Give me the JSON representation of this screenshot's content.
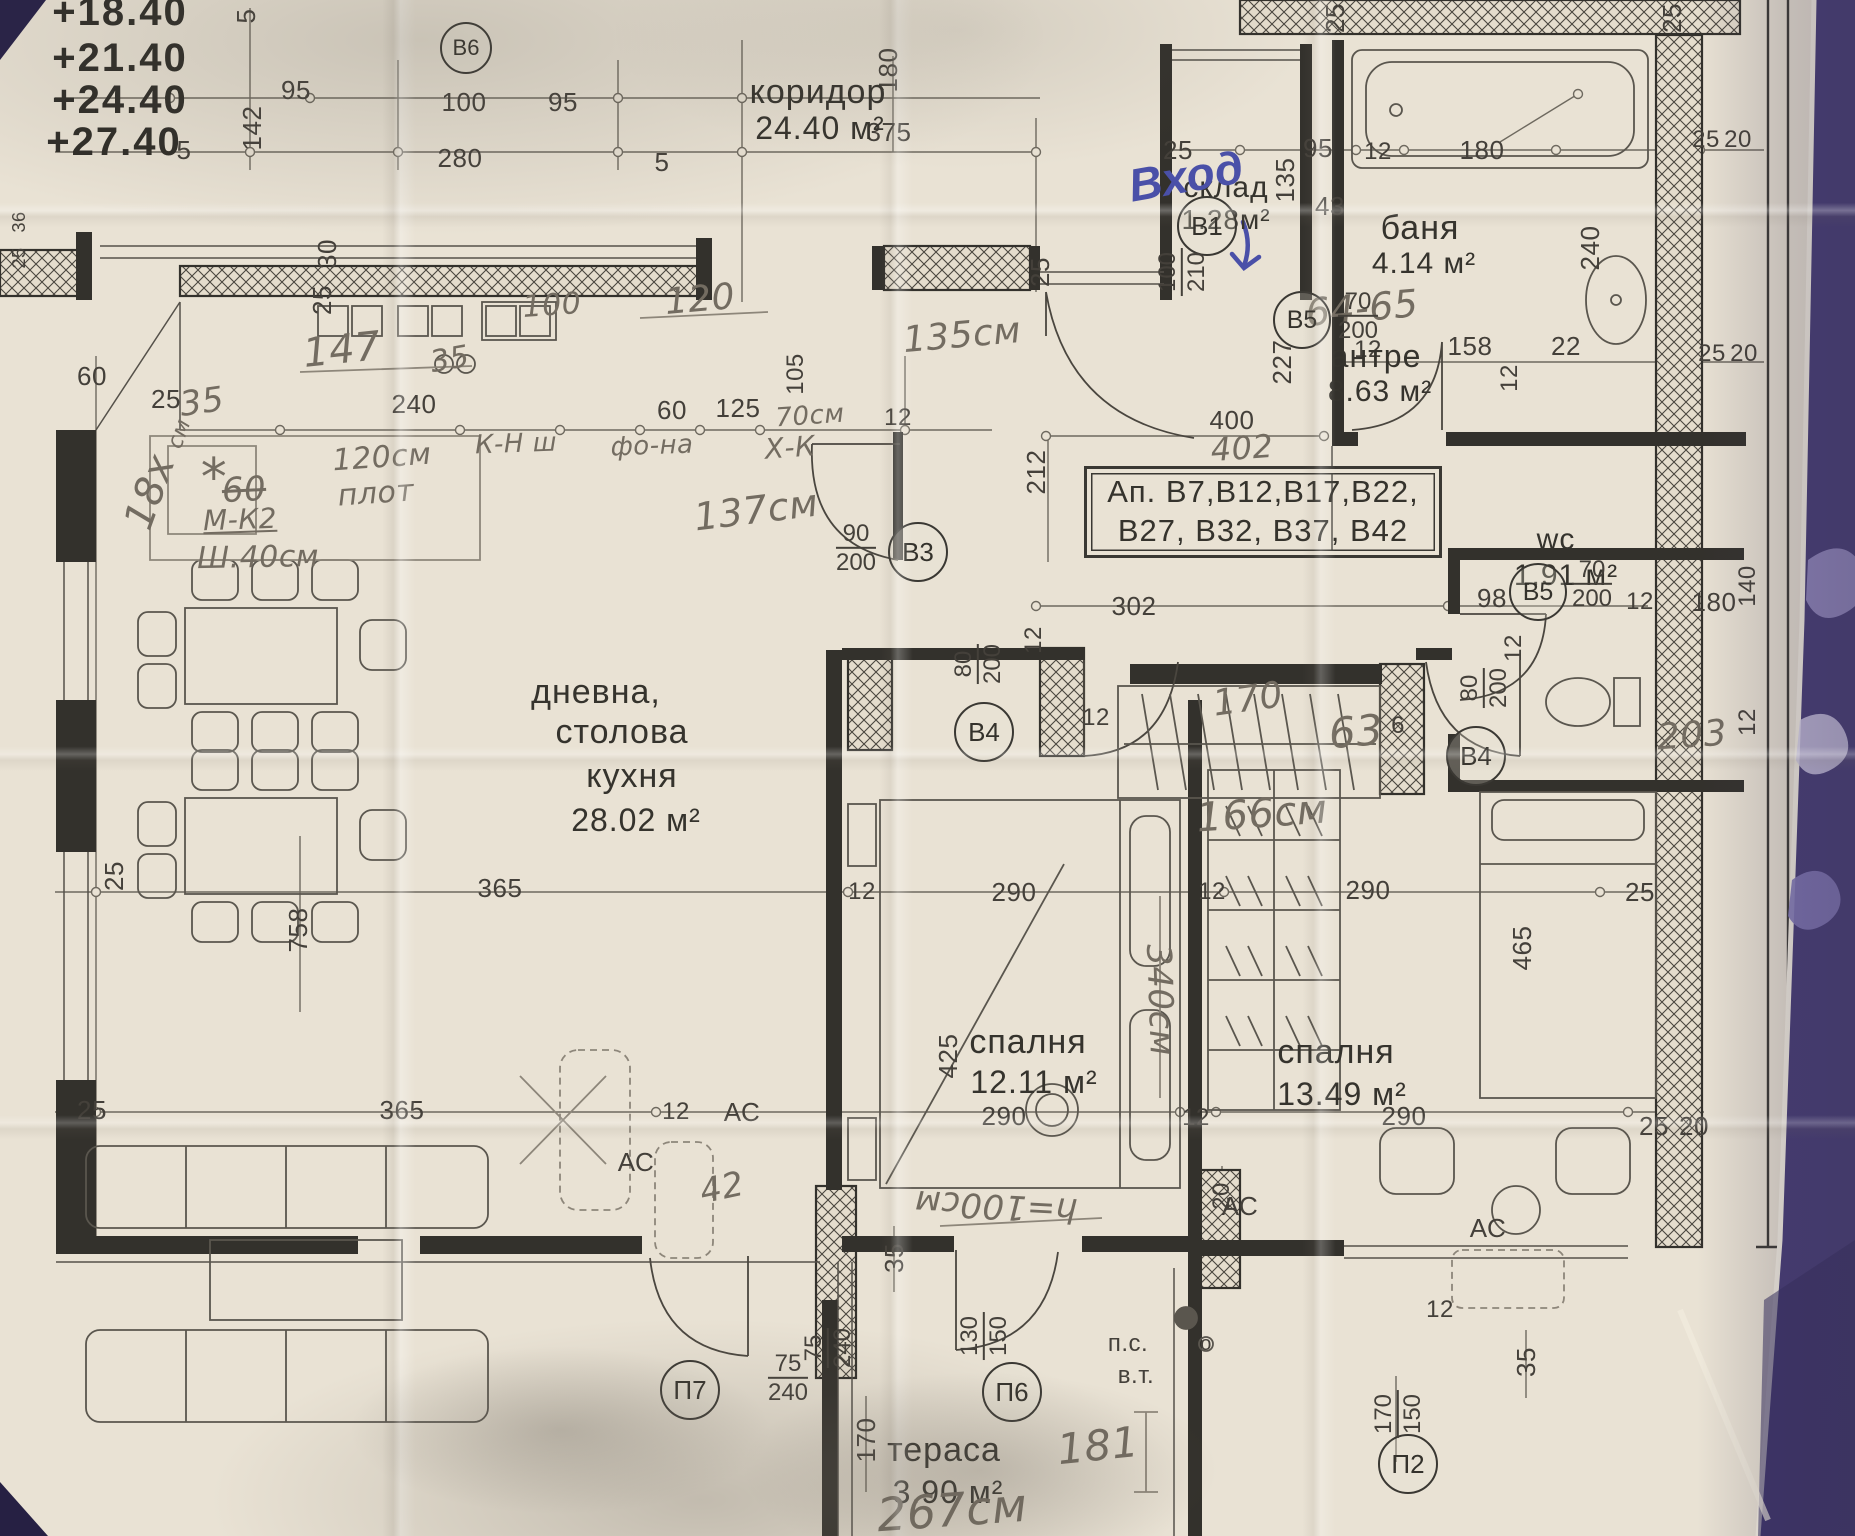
{
  "photo": {
    "description": "Photographed architectural floor plan of apartment, Bulgarian labels, with pencil and blue-pen handwriting, lying on purple fabric",
    "fabric_color": "#453b76",
    "paper_color": "#e9e2d4",
    "print_ink_color": "#3a3833",
    "pencil_color": "#736c61",
    "pen_color": "#4a50a8"
  },
  "floor_plan": {
    "rooms_summary": [
      {
        "name": "коридор",
        "area": "24.40 м²"
      },
      {
        "name": "склад",
        "area": "1.28м²"
      },
      {
        "name": "баня",
        "area": "4.14 м²"
      },
      {
        "name": "антре",
        "area": "8.63 м²"
      },
      {
        "name": "wc",
        "area": "1.91 м²"
      },
      {
        "name": "дневна, столова кухня",
        "area": "28.02 м²"
      },
      {
        "name": "спалня",
        "area": "12.11 м²"
      },
      {
        "name": "спалня",
        "area": "13.49 м²"
      },
      {
        "name": "тераса",
        "area": "3.90 м²"
      }
    ],
    "apartment_list_box": {
      "line1": "Ап. В7,В12,В17,В22,",
      "line2": "В27, В32, В37, В42",
      "x": 1084,
      "y": 466,
      "w": 352,
      "h": 86
    },
    "elevation_marks": [
      {
        "t": "+18.40",
        "x": 120,
        "y": 12
      },
      {
        "t": "+21.40",
        "x": 120,
        "y": 58
      },
      {
        "t": "+24.40",
        "x": 120,
        "y": 100
      },
      {
        "t": "+27.40",
        "x": 114,
        "y": 142
      }
    ],
    "room_labels": [
      {
        "t": "коридор",
        "x": 818,
        "y": 92,
        "s": 34
      },
      {
        "t": "24.40 м²",
        "x": 820,
        "y": 128,
        "s": 32
      },
      {
        "t": "склад",
        "x": 1226,
        "y": 188,
        "s": 30
      },
      {
        "t": "1.28м²",
        "x": 1226,
        "y": 220,
        "s": 28
      },
      {
        "t": "баня",
        "x": 1420,
        "y": 228,
        "s": 34
      },
      {
        "t": "4.14 м²",
        "x": 1424,
        "y": 264,
        "s": 30
      },
      {
        "t": "антре",
        "x": 1376,
        "y": 356,
        "s": 32
      },
      {
        "t": "8.63 м²",
        "x": 1380,
        "y": 392,
        "s": 30
      },
      {
        "t": "wc",
        "x": 1556,
        "y": 540,
        "s": 30
      },
      {
        "t": "1.91 м²",
        "x": 1566,
        "y": 576,
        "s": 30
      },
      {
        "t": "дневна,",
        "x": 596,
        "y": 692,
        "s": 34
      },
      {
        "t": "столова",
        "x": 622,
        "y": 732,
        "s": 34
      },
      {
        "t": "кухня",
        "x": 632,
        "y": 776,
        "s": 34
      },
      {
        "t": "28.02 м²",
        "x": 636,
        "y": 820,
        "s": 32
      },
      {
        "t": "спалня",
        "x": 1028,
        "y": 1042,
        "s": 34
      },
      {
        "t": "12.11 м²",
        "x": 1034,
        "y": 1082,
        "s": 32
      },
      {
        "t": "спалня",
        "x": 1336,
        "y": 1052,
        "s": 34
      },
      {
        "t": "13.49 м²",
        "x": 1342,
        "y": 1094,
        "s": 32
      },
      {
        "t": "тераса",
        "x": 944,
        "y": 1450,
        "s": 34
      },
      {
        "t": "3.90 м²",
        "x": 948,
        "y": 1492,
        "s": 32
      }
    ],
    "door_marks": [
      {
        "id": "В6",
        "x": 464,
        "y": 46,
        "d": 48
      },
      {
        "id": "В1",
        "x": 1205,
        "y": 224,
        "d": 56
      },
      {
        "id": "В3",
        "x": 916,
        "y": 550,
        "d": 56
      },
      {
        "id": "В4",
        "x": 982,
        "y": 730,
        "d": 56
      },
      {
        "id": "В4",
        "x": 1474,
        "y": 754,
        "d": 56
      },
      {
        "id": "В5",
        "x": 1300,
        "y": 318,
        "d": 54
      },
      {
        "id": "В5",
        "x": 1536,
        "y": 590,
        "d": 54
      },
      {
        "id": "П7",
        "x": 688,
        "y": 1388,
        "d": 56
      },
      {
        "id": "П6",
        "x": 1010,
        "y": 1390,
        "d": 56
      },
      {
        "id": "П2",
        "x": 1406,
        "y": 1462,
        "d": 56
      }
    ],
    "fractions": [
      {
        "top": "100",
        "bottom": "210",
        "x": 1182,
        "y": 272,
        "r": -90
      },
      {
        "top": "90",
        "bottom": "200",
        "x": 856,
        "y": 548
      },
      {
        "top": "80",
        "bottom": "200",
        "x": 978,
        "y": 664,
        "r": -90
      },
      {
        "top": "80",
        "bottom": "200",
        "x": 1484,
        "y": 688,
        "r": -90
      },
      {
        "top": "70",
        "bottom": "200",
        "x": 1358,
        "y": 316
      },
      {
        "top": "70",
        "bottom": "200",
        "x": 1592,
        "y": 584
      },
      {
        "top": "75",
        "bottom": "240",
        "x": 788,
        "y": 1378
      },
      {
        "top": "75",
        "bottom": "240",
        "x": 828,
        "y": 1348,
        "r": -90
      },
      {
        "top": "130",
        "bottom": "150",
        "x": 984,
        "y": 1336,
        "r": -90
      },
      {
        "top": "170",
        "bottom": "150",
        "x": 1398,
        "y": 1414,
        "r": -90
      }
    ],
    "dimensions": [
      {
        "t": "5",
        "x": 246,
        "y": 16,
        "r": -90
      },
      {
        "t": "95",
        "x": 296,
        "y": 90
      },
      {
        "t": "142",
        "x": 252,
        "y": 128,
        "r": -90
      },
      {
        "t": "5",
        "x": 184,
        "y": 150
      },
      {
        "t": "100",
        "x": 464,
        "y": 102
      },
      {
        "t": "95",
        "x": 563,
        "y": 102
      },
      {
        "t": "280",
        "x": 460,
        "y": 158
      },
      {
        "t": "5",
        "x": 662,
        "y": 162
      },
      {
        "t": "180",
        "x": 888,
        "y": 70,
        "r": -90
      },
      {
        "t": "375",
        "x": 889,
        "y": 132
      },
      {
        "t": "30",
        "x": 327,
        "y": 254,
        "r": -90
      },
      {
        "t": "25",
        "x": 322,
        "y": 300,
        "r": -90
      },
      {
        "t": "36",
        "x": 19,
        "y": 222,
        "r": -90,
        "s": 18
      },
      {
        "t": "25",
        "x": 19,
        "y": 258,
        "r": -90,
        "s": 18
      },
      {
        "t": "25",
        "x": 1040,
        "y": 272,
        "r": -90
      },
      {
        "t": "25",
        "x": 1335,
        "y": 18,
        "r": -90
      },
      {
        "t": "25",
        "x": 1672,
        "y": 18,
        "r": -90
      },
      {
        "t": "43",
        "x": 1330,
        "y": 206
      },
      {
        "t": "25",
        "x": 1178,
        "y": 150
      },
      {
        "t": "95",
        "x": 1318,
        "y": 148
      },
      {
        "t": "12",
        "x": 1378,
        "y": 152,
        "s": 24
      },
      {
        "t": "180",
        "x": 1482,
        "y": 150
      },
      {
        "t": "25",
        "x": 1706,
        "y": 140,
        "s": 24
      },
      {
        "t": "20",
        "x": 1738,
        "y": 140,
        "s": 24
      },
      {
        "t": "135",
        "x": 1285,
        "y": 180,
        "r": -90
      },
      {
        "t": "240",
        "x": 1590,
        "y": 248,
        "r": -90
      },
      {
        "t": "227",
        "x": 1282,
        "y": 362,
        "r": -90
      },
      {
        "t": "12",
        "x": 1368,
        "y": 350,
        "s": 24
      },
      {
        "t": "158",
        "x": 1470,
        "y": 346
      },
      {
        "t": "22",
        "x": 1566,
        "y": 346
      },
      {
        "t": "25",
        "x": 1712,
        "y": 354,
        "s": 24
      },
      {
        "t": "20",
        "x": 1744,
        "y": 354,
        "s": 24
      },
      {
        "t": "12",
        "x": 1510,
        "y": 378,
        "r": -90,
        "s": 24
      },
      {
        "t": "400",
        "x": 1232,
        "y": 420
      },
      {
        "t": "212",
        "x": 1036,
        "y": 472,
        "r": -90
      },
      {
        "t": "60",
        "x": 92,
        "y": 376
      },
      {
        "t": "25",
        "x": 166,
        "y": 399
      },
      {
        "t": "240",
        "x": 414,
        "y": 404
      },
      {
        "t": "60",
        "x": 672,
        "y": 410
      },
      {
        "t": "125",
        "x": 738,
        "y": 408
      },
      {
        "t": "12",
        "x": 898,
        "y": 418,
        "s": 24
      },
      {
        "t": "105",
        "x": 796,
        "y": 374,
        "r": -90,
        "s": 24
      },
      {
        "t": "302",
        "x": 1134,
        "y": 606
      },
      {
        "t": "12",
        "x": 1034,
        "y": 640,
        "r": -90,
        "s": 24
      },
      {
        "t": "98",
        "x": 1492,
        "y": 598
      },
      {
        "t": "12",
        "x": 1640,
        "y": 602,
        "s": 24
      },
      {
        "t": "180",
        "x": 1714,
        "y": 602
      },
      {
        "t": "140",
        "x": 1748,
        "y": 586,
        "r": -90,
        "s": 24
      },
      {
        "t": "12",
        "x": 1748,
        "y": 722,
        "r": -90,
        "s": 24
      },
      {
        "t": "12",
        "x": 1096,
        "y": 718,
        "s": 24
      },
      {
        "t": "6",
        "x": 1398,
        "y": 726,
        "s": 24
      },
      {
        "t": "12",
        "x": 1514,
        "y": 648,
        "r": -90,
        "s": 24
      },
      {
        "t": "25",
        "x": 114,
        "y": 876,
        "r": -90
      },
      {
        "t": "758",
        "x": 298,
        "y": 930,
        "r": -90
      },
      {
        "t": "365",
        "x": 500,
        "y": 888
      },
      {
        "t": "12",
        "x": 862,
        "y": 892,
        "s": 24
      },
      {
        "t": "290",
        "x": 1014,
        "y": 892
      },
      {
        "t": "12",
        "x": 1212,
        "y": 892,
        "s": 24
      },
      {
        "t": "290",
        "x": 1368,
        "y": 890
      },
      {
        "t": "25",
        "x": 1640,
        "y": 892
      },
      {
        "t": "425",
        "x": 948,
        "y": 1056,
        "r": -90
      },
      {
        "t": "465",
        "x": 1522,
        "y": 948,
        "r": -90
      },
      {
        "t": "25",
        "x": 92,
        "y": 1110
      },
      {
        "t": "365",
        "x": 402,
        "y": 1110
      },
      {
        "t": "12",
        "x": 676,
        "y": 1112,
        "s": 24
      },
      {
        "t": "290",
        "x": 1004,
        "y": 1116
      },
      {
        "t": "12",
        "x": 1196,
        "y": 1118,
        "s": 24
      },
      {
        "t": "290",
        "x": 1404,
        "y": 1116
      },
      {
        "t": "25",
        "x": 1654,
        "y": 1126
      },
      {
        "t": "20",
        "x": 1694,
        "y": 1126
      },
      {
        "t": "20",
        "x": 1222,
        "y": 1196,
        "r": -90,
        "s": 24
      },
      {
        "t": "35",
        "x": 894,
        "y": 1258,
        "r": -90
      },
      {
        "t": "170",
        "x": 866,
        "y": 1440,
        "r": -90
      },
      {
        "t": "35",
        "x": 1526,
        "y": 1362,
        "r": -90
      },
      {
        "t": "12",
        "x": 1440,
        "y": 1310,
        "s": 24
      }
    ],
    "ac_labels": [
      {
        "t": "АС",
        "x": 636,
        "y": 1162
      },
      {
        "t": "АС",
        "x": 742,
        "y": 1112
      },
      {
        "t": "АС",
        "x": 1240,
        "y": 1206
      },
      {
        "t": "АС",
        "x": 1488,
        "y": 1228
      }
    ],
    "misc_labels": [
      {
        "t": "п.с.",
        "x": 1128,
        "y": 1344,
        "s": 24
      },
      {
        "t": "в.т.",
        "x": 1136,
        "y": 1376,
        "s": 24
      },
      {
        "t": "о",
        "x": 1206,
        "y": 1344,
        "s": 20
      }
    ],
    "pencil_notes": [
      {
        "t": "147",
        "x": 342,
        "y": 350,
        "r": -6,
        "s": 40
      },
      {
        "t": "35",
        "x": 450,
        "y": 360,
        "r": -10,
        "s": 30
      },
      {
        "t": "100",
        "x": 552,
        "y": 306,
        "r": -4,
        "s": 30
      },
      {
        "t": "120",
        "x": 700,
        "y": 300,
        "r": -5,
        "s": 36
      },
      {
        "t": "35",
        "x": 202,
        "y": 402,
        "r": -8,
        "s": 34
      },
      {
        "t": "135см",
        "x": 962,
        "y": 336,
        "r": -5,
        "s": 36
      },
      {
        "t": "70см",
        "x": 810,
        "y": 416,
        "r": -4,
        "s": 26
      },
      {
        "t": "К-Н ш",
        "x": 516,
        "y": 444,
        "r": -2,
        "s": 26
      },
      {
        "t": "фо-на",
        "x": 652,
        "y": 446,
        "r": -2,
        "s": 26
      },
      {
        "t": "Х-К",
        "x": 790,
        "y": 448,
        "r": -4,
        "s": 28
      },
      {
        "t": "120см",
        "x": 382,
        "y": 458,
        "r": -4,
        "s": 30
      },
      {
        "t": "плот",
        "x": 376,
        "y": 494,
        "r": -4,
        "s": 30
      },
      {
        "t": "*",
        "x": 214,
        "y": 478,
        "s": 52
      },
      {
        "t": "60",
        "x": 244,
        "y": 490,
        "r": -3,
        "s": 34,
        "c": "strike"
      },
      {
        "t": "М-К2",
        "x": 240,
        "y": 520,
        "r": -2,
        "s": 28,
        "c": "ul"
      },
      {
        "t": "Ш.40см",
        "x": 258,
        "y": 558,
        "r": -1,
        "s": 30
      },
      {
        "t": "18х",
        "x": 150,
        "y": 492,
        "r": -70,
        "s": 40
      },
      {
        "t": "см",
        "x": 180,
        "y": 434,
        "r": -70,
        "s": 22
      },
      {
        "t": "137см",
        "x": 756,
        "y": 510,
        "r": -7,
        "s": 38
      },
      {
        "t": "64-65",
        "x": 1362,
        "y": 308,
        "r": -5,
        "s": 38
      },
      {
        "t": "402",
        "x": 1242,
        "y": 448,
        "r": -4,
        "s": 32
      },
      {
        "t": "170",
        "x": 1248,
        "y": 700,
        "r": -8,
        "s": 36
      },
      {
        "t": "63",
        "x": 1356,
        "y": 732,
        "r": -5,
        "s": 42
      },
      {
        "t": "166см",
        "x": 1262,
        "y": 814,
        "r": -4,
        "s": 40
      },
      {
        "t": "203",
        "x": 1692,
        "y": 736,
        "r": -4,
        "s": 36
      },
      {
        "t": "340см",
        "x": 1160,
        "y": 1000,
        "r": 88,
        "s": 34
      },
      {
        "t": "42",
        "x": 722,
        "y": 1188,
        "r": -12,
        "s": 34
      },
      {
        "t": "h=100см",
        "x": 996,
        "y": 1206,
        "r": 183,
        "s": 34
      },
      {
        "t": "181",
        "x": 1098,
        "y": 1446,
        "r": -6,
        "s": 42
      },
      {
        "t": "267см",
        "x": 952,
        "y": 1510,
        "r": -4,
        "s": 46
      }
    ],
    "pen_notes": [
      {
        "t": "Вход",
        "x": 1186,
        "y": 176,
        "r": -10,
        "s": 46
      }
    ]
  }
}
